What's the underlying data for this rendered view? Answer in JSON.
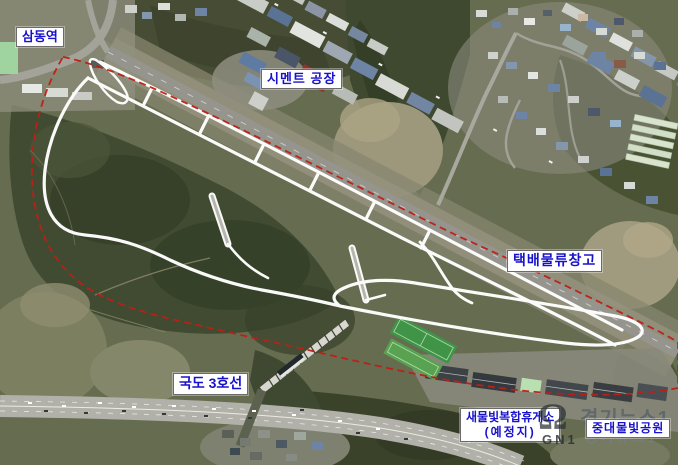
{
  "annotations": {
    "samdong_station": "삼동역",
    "cement_factory": "시멘트 공장",
    "parcel_logistics_warehouse": "택배물류창고",
    "national_route_3": "국도 3호선",
    "rest_area_name": "새물빛복합휴게소",
    "rest_area_status": "(예정지)",
    "mulbit_park": "중대물빛공원"
  },
  "watermark": {
    "logo_mark": "Ω",
    "logo_text": "GN1",
    "line1": "경기뉴스1",
    "line2": "경기뉴스1"
  },
  "colors": {
    "annotation_text": "#1712cb",
    "annotation_background": "#ffffff",
    "site_boundary": "#c01d15",
    "planned_road_overlay": "#ffffff"
  }
}
